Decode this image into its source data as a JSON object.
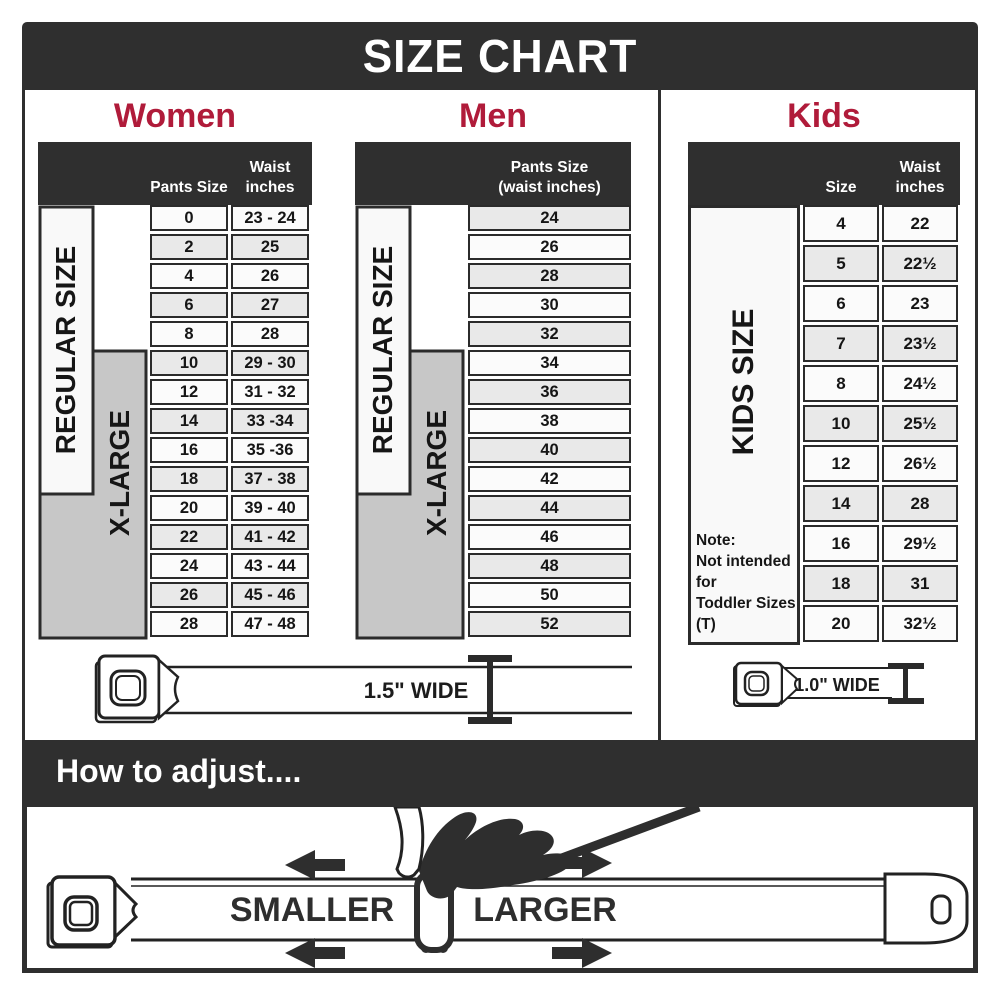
{
  "title": "SIZE CHART",
  "colors": {
    "band_dark": "#2f2f2f",
    "accent_red": "#b01b3a",
    "row_light": "#fbfbfb",
    "row_shade": "#e9e9e9",
    "xlarge_gray": "#c7c7c7",
    "line_dark": "#2b2b2b"
  },
  "sections": {
    "women": {
      "heading": "Women",
      "col1_header": "Pants Size",
      "col2_header_line1": "Waist",
      "col2_header_line2": "inches",
      "regular_label": "REGULAR SIZE",
      "xlarge_label": "X-LARGE",
      "rows": [
        {
          "size": "0",
          "waist": "23 - 24"
        },
        {
          "size": "2",
          "waist": "25"
        },
        {
          "size": "4",
          "waist": "26"
        },
        {
          "size": "6",
          "waist": "27"
        },
        {
          "size": "8",
          "waist": "28"
        },
        {
          "size": "10",
          "waist": "29 - 30"
        },
        {
          "size": "12",
          "waist": "31 - 32"
        },
        {
          "size": "14",
          "waist": "33 -34"
        },
        {
          "size": "16",
          "waist": "35 -36"
        },
        {
          "size": "18",
          "waist": "37 - 38"
        },
        {
          "size": "20",
          "waist": "39 - 40"
        },
        {
          "size": "22",
          "waist": "41 - 42"
        },
        {
          "size": "24",
          "waist": "43 - 44"
        },
        {
          "size": "26",
          "waist": "45 - 46"
        },
        {
          "size": "28",
          "waist": "47 - 48"
        }
      ]
    },
    "men": {
      "heading": "Men",
      "col_header_line1": "Pants Size",
      "col_header_line2": "(waist inches)",
      "regular_label": "REGULAR SIZE",
      "xlarge_label": "X-LARGE",
      "rows": [
        "24",
        "26",
        "28",
        "30",
        "32",
        "34",
        "36",
        "38",
        "40",
        "42",
        "44",
        "46",
        "48",
        "50",
        "52"
      ]
    },
    "kids": {
      "heading": "Kids",
      "col1_header": "Size",
      "col2_header_line1": "Waist",
      "col2_header_line2": "inches",
      "side_label": "KIDS SIZE",
      "note_line1": "Note:",
      "note_line2": "Not intended for",
      "note_line3": "Toddler Sizes (T)",
      "rows": [
        {
          "size": "4",
          "waist": "22"
        },
        {
          "size": "5",
          "waist": "22½"
        },
        {
          "size": "6",
          "waist": "23"
        },
        {
          "size": "7",
          "waist": "23½"
        },
        {
          "size": "8",
          "waist": "24½"
        },
        {
          "size": "10",
          "waist": "25½"
        },
        {
          "size": "12",
          "waist": "26½"
        },
        {
          "size": "14",
          "waist": "28"
        },
        {
          "size": "16",
          "waist": "29½"
        },
        {
          "size": "18",
          "waist": "31"
        },
        {
          "size": "20",
          "waist": "32½"
        }
      ]
    }
  },
  "belts": {
    "adult_width_label": "1.5\" WIDE",
    "kids_width_label": "1.0\" WIDE"
  },
  "how_to": {
    "heading": "How to adjust....",
    "smaller_label": "SMALLER",
    "larger_label": "LARGER"
  }
}
